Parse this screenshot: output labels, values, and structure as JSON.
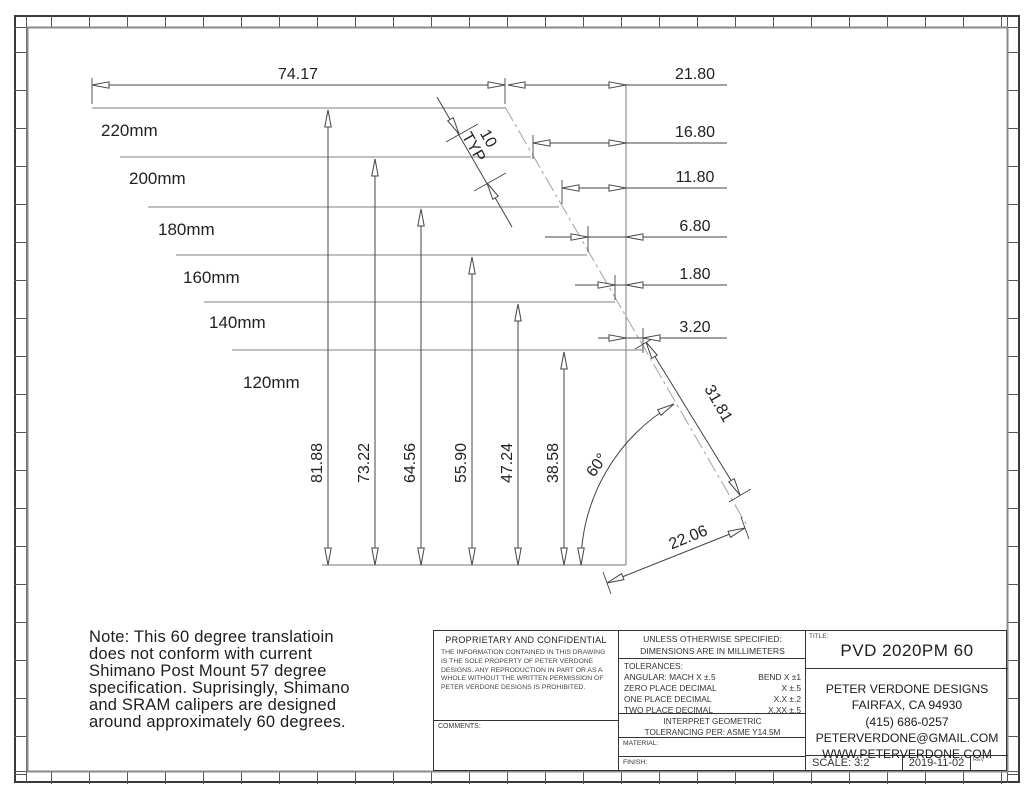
{
  "drawing": {
    "top_dim": "74.17",
    "right_dims": [
      "21.80",
      "16.80",
      "11.80",
      "6.80",
      "1.80",
      "3.20"
    ],
    "rotor_labels": [
      "220mm",
      "200mm",
      "180mm",
      "160mm",
      "140mm",
      "120mm"
    ],
    "vertical_dims": [
      "81.88",
      "73.22",
      "64.56",
      "55.90",
      "47.24",
      "38.58"
    ],
    "angle_dim": "60°",
    "typ_value": "10",
    "typ_suffix": "TYP",
    "diag_dim_upper": "31.81",
    "diag_dim_lower": "22.06"
  },
  "note": {
    "lines": [
      "Note: This 60 degree translatioin",
      "does not conform with current",
      "Shimano Post Mount 57 degree",
      "specification. Suprisingly, Shimano",
      "and SRAM calipers are designed",
      "around approximately 60 degrees."
    ]
  },
  "title_block": {
    "proprietary": {
      "heading": "PROPRIETARY AND CONFIDENTIAL",
      "body_lines": [
        "THE INFORMATION CONTAINED IN THIS DRAWING",
        "IS THE SOLE PROPERTY OF PETER VERDONE",
        "DESIGNS.  ANY  REPRODUCTION IN PART OR AS A",
        "WHOLE WITHOUT THE WRITTEN PERMISSION OF",
        "PETER VERDONE DESIGNS IS PROHIBITED."
      ],
      "comments_label": "COMMENTS:"
    },
    "specs": {
      "unless_line1": "UNLESS OTHERWISE SPECIFIED:",
      "unless_line2": "DIMENSIONS ARE IN MILLIMETERS",
      "tolerances_heading": "TOLERANCES:",
      "tolerance_rows": [
        {
          "label": "ANGULAR: MACH X ±.5",
          "value": "BEND X ±1"
        },
        {
          "label": "ZERO PLACE DECIMAL",
          "value": "X ±.5"
        },
        {
          "label": "ONE PLACE DECIMAL",
          "value": "X.X ±.2"
        },
        {
          "label": "TWO PLACE DECIMAL",
          "value": "X.XX ±.5"
        }
      ],
      "interpret_line1": "INTERPRET GEOMETRIC",
      "interpret_line2": "TOLERANCING PER: ASME Y14.5M",
      "material_label": "MATERIAL:",
      "finish_label": "FINISH:"
    },
    "title": {
      "label": "TITLE:",
      "text": "PVD 2020PM 60"
    },
    "company_lines": [
      "PETER VERDONE DESIGNS",
      "FAIRFAX, CA 94930",
      "(415) 686-0257",
      "PETERVERDONE@GMAIL.COM",
      "WWW.PETERVERDONE.COM"
    ],
    "scale": "SCALE: 3:2",
    "date": "2019-11-02",
    "rev_label": "REV"
  }
}
